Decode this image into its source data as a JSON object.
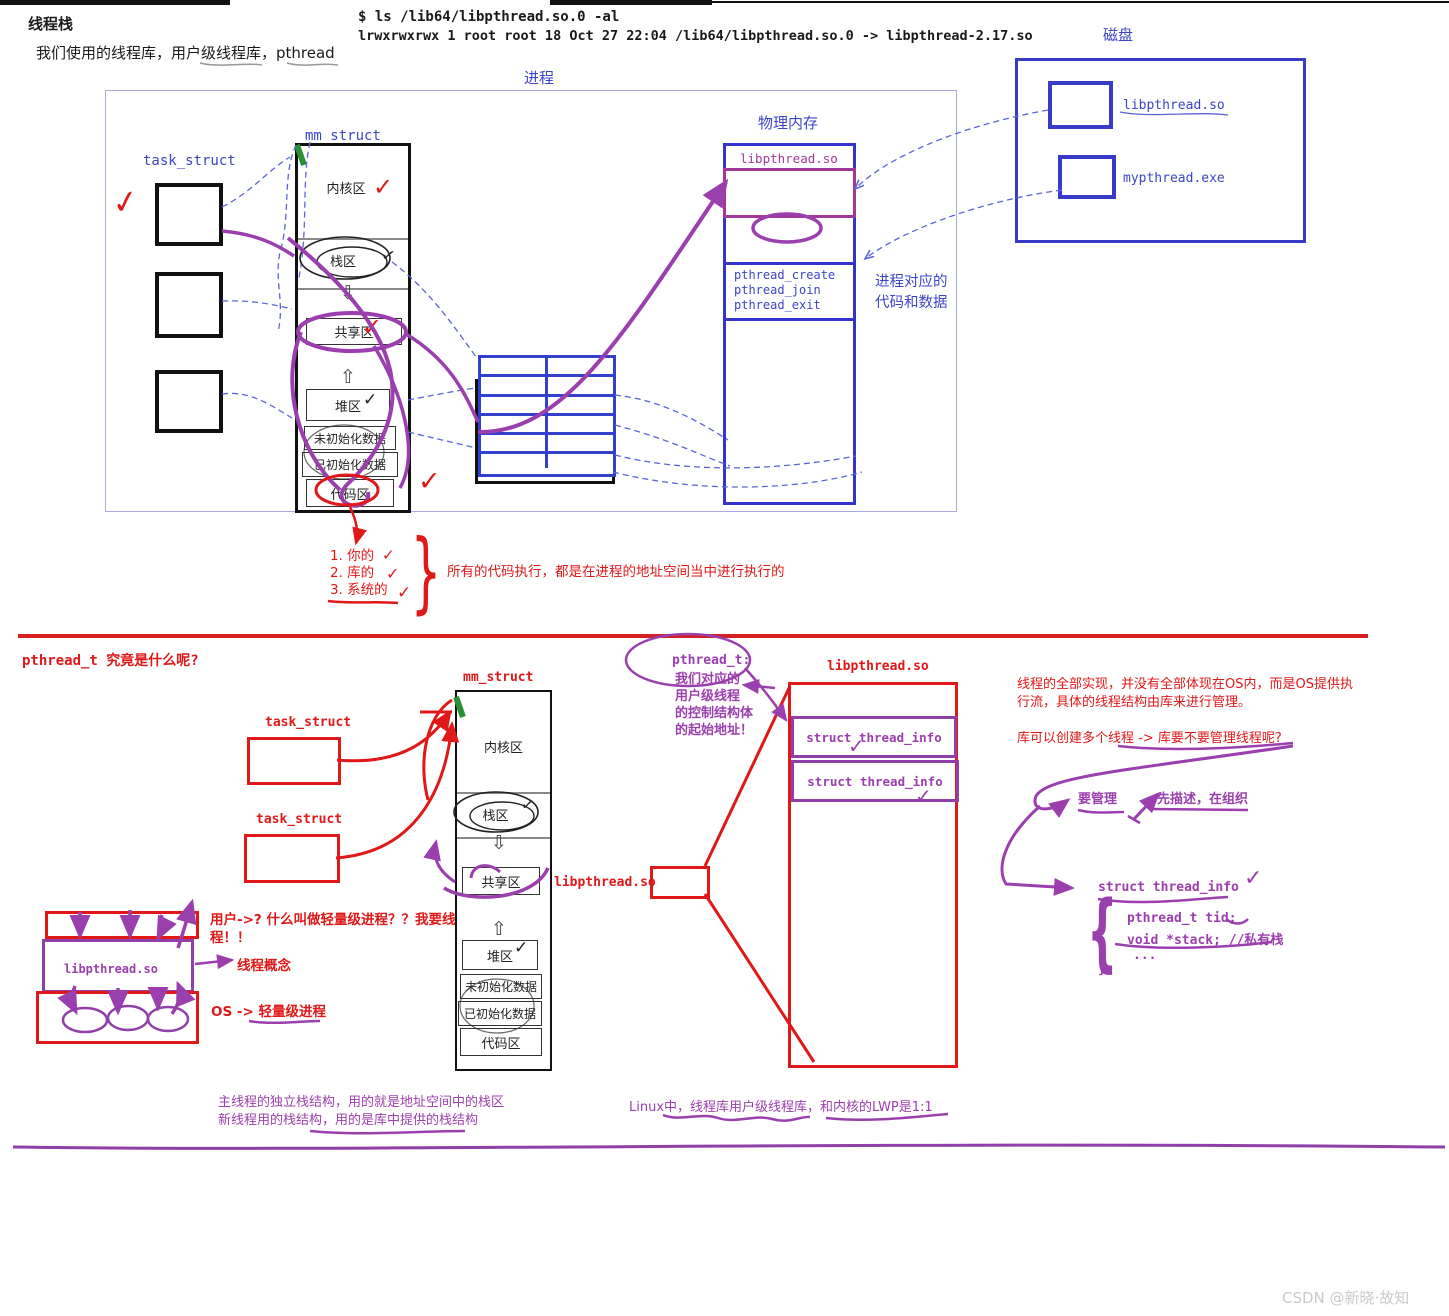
{
  "icons": {
    "check": "✓",
    "block_arrow_down": "⇩",
    "block_arrow_up": "⇧",
    "brace_left": "{",
    "brace_right": "}"
  },
  "colors": {
    "blue": "#3c44c8",
    "purple": "#9b3fae",
    "red": "#e01818"
  },
  "header": {
    "title": "线程栈",
    "subtitle": "我们使用的线程库，用户级线程库，pthread",
    "terminal_line1": "$ ls /lib64/libpthread.so.0 -al",
    "terminal_line2": "lrwxrwxrwx 1 root root 18 Oct 27 22:04 /lib64/libpthread.so.0 -> libpthread-2.17.so"
  },
  "process": {
    "label": "进程",
    "task_struct_label": "task_struct",
    "mm_struct_label": "mm_struct",
    "segments": {
      "kernel": "内核区",
      "stack": "栈区",
      "shared": "共享区",
      "heap": "堆区",
      "uninit": "未初始化数据",
      "init": "已初始化数据",
      "code": "代码区"
    }
  },
  "physical_memory": {
    "label": "物理内存",
    "lib": "libpthread.so",
    "fn1": "pthread_create",
    "fn2": "pthread_join",
    "fn3": "pthread_exit",
    "note_line1": "进程对应的",
    "note_line2": "代码和数据"
  },
  "disk": {
    "label": "磁盘",
    "item1": "libpthread.so",
    "item2": "mypthread.exe"
  },
  "code_origin": {
    "item1": "1. 你的",
    "item2": "2. 库的",
    "item3": "3. 系统的",
    "note": "所有的代码执行，都是在进程的地址空间当中进行执行的"
  },
  "bottom": {
    "question": "pthread_t 究竟是什么呢?",
    "task_struct_label": "task_struct",
    "mm_struct_label": "mm_struct",
    "shared_lib": "libpthread.so",
    "pthread_t_note": {
      "title": "pthread_t:",
      "l1": "我们对应的",
      "l2": "用户级线程",
      "l3": "的控制结构体",
      "l4": "的起始地址！"
    },
    "libbox_label": "libpthread.so",
    "thread_info": "struct thread_info",
    "impl_note_l1": "线程的全部实现，并没有全部体现在OS内，而是OS提供执",
    "impl_note_l2": "行流，具体的线程结构由库来进行管理。",
    "create_note": "库可以创建多个线程 -> 库要不要管理线程呢?",
    "manage": "要管理",
    "describe": "先描述，在组织",
    "code_block": {
      "l1": "struct thread_info",
      "l2": "pthread_t tid;",
      "l3": "void *stack; //私有栈",
      "l4": "..."
    },
    "lwp": {
      "lib": "libpthread.so",
      "user_q": "用户->? 什么叫做轻量级进程？？我要线程！！",
      "concept": "线程概念",
      "os": "OS -> 轻量级进程"
    },
    "stack_note_l1": "主线程的独立栈结构，用的就是地址空间中的栈区",
    "stack_note_l2": "新线程用的栈结构，用的是库中提供的栈结构",
    "linux_note": "Linux中，线程库用户级线程库，和内核的LWP是1:1"
  },
  "watermark": "CSDN @新晓·故知"
}
